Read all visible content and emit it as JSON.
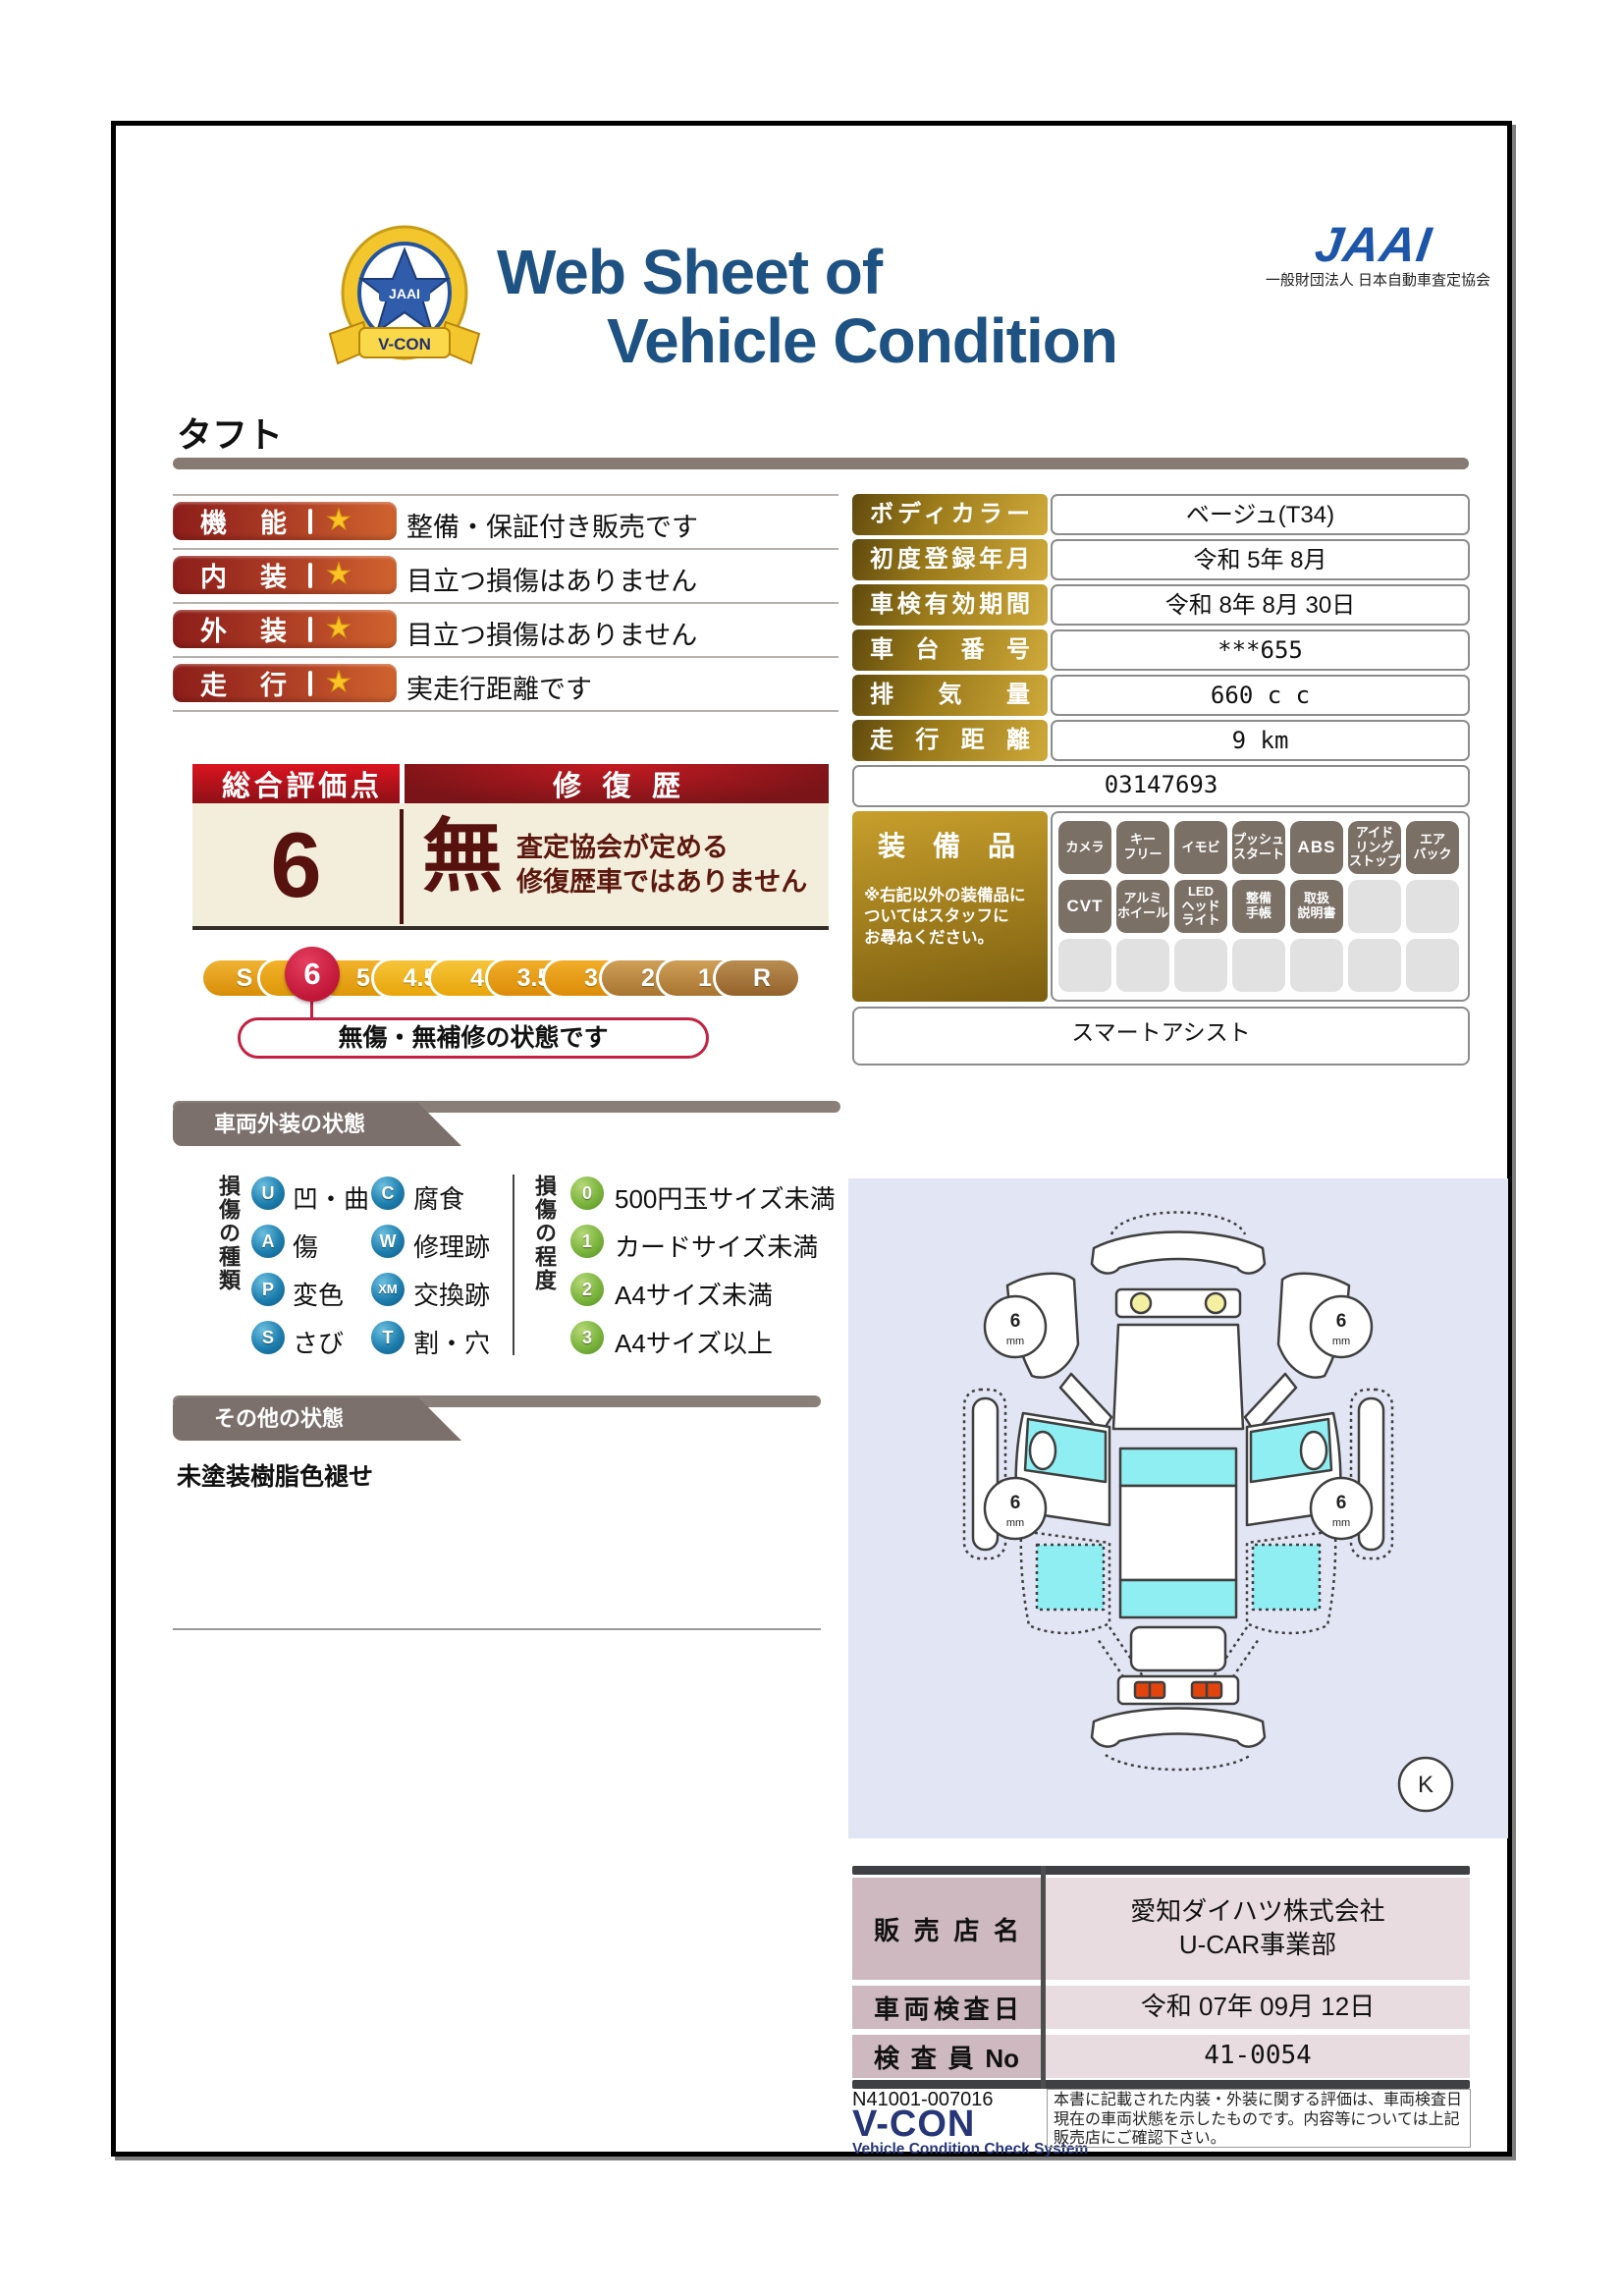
{
  "header": {
    "title_line1": "Web Sheet of",
    "title_line2": "Vehicle Condition",
    "jaai_logo": "JAAI",
    "jaai_subtitle": "一般財団法人 日本自動車査定協会",
    "badge_ribbon": "V-CON",
    "badge_center": "JAAI"
  },
  "vehicle_name": "タフト",
  "ratings": [
    {
      "label": "機能",
      "comment": "整備・保証付き販売です"
    },
    {
      "label": "内装",
      "comment": "目立つ損傷はありません"
    },
    {
      "label": "外装",
      "comment": "目立つ損傷はありません"
    },
    {
      "label": "走行",
      "comment": "実走行距離です"
    }
  ],
  "overall": {
    "header_left": "総合評価点",
    "header_right": "修復歴",
    "score": "6",
    "repair": "無",
    "repair_note_line1": "査定協会が定める",
    "repair_note_line2": "修復歴車ではありません",
    "scale": [
      "S",
      "6",
      "5",
      "4.5",
      "4",
      "3.5",
      "3",
      "2",
      "1",
      "R"
    ],
    "selected": "6",
    "bubble": "無傷・無補修の状態です"
  },
  "info_table": {
    "rows": [
      {
        "label": "ボディカラー",
        "value": "ベージュ(T34)"
      },
      {
        "label": "初度登録年月",
        "value": "令和 5年 8月"
      },
      {
        "label": "車検有効期間",
        "value": "令和 8年 8月 30日"
      },
      {
        "label": "車台番号",
        "value": "***655"
      },
      {
        "label": "排気量",
        "value": "660 c c"
      },
      {
        "label": "走行距離",
        "value": "9 km"
      }
    ],
    "code": "03147693"
  },
  "equipment": {
    "title": "装備品",
    "note": "※右記以外の装備品に\nついてはスタッフに\nお尋ねください。",
    "row1": [
      "カメラ",
      "キー\nフリー",
      "イモビ",
      "プッシュ\nスタート",
      "ABS",
      "アイド\nリング\nストップ",
      "エア\nバック"
    ],
    "row2": [
      "CVT",
      "アルミ\nホイール",
      "LED\nヘッド\nライト",
      "整備\n手帳",
      "取扱\n説明書"
    ],
    "extra": "スマートアシスト"
  },
  "exterior": {
    "section_title": "車両外装の状態",
    "type_label": "損傷の種類",
    "types": [
      {
        "code": "U",
        "label": "凹・曲"
      },
      {
        "code": "C",
        "label": "腐食"
      },
      {
        "code": "A",
        "label": "傷"
      },
      {
        "code": "W",
        "label": "修理跡"
      },
      {
        "code": "P",
        "label": "変色"
      },
      {
        "code": "XM",
        "label": "交換跡"
      },
      {
        "code": "S",
        "label": "さび"
      },
      {
        "code": "T",
        "label": "割・穴"
      }
    ],
    "degree_label": "損傷の程度",
    "degrees": [
      {
        "code": "0",
        "label": "500円玉サイズ未満"
      },
      {
        "code": "1",
        "label": "カードサイズ未満"
      },
      {
        "code": "2",
        "label": "A4サイズ未満"
      },
      {
        "code": "3",
        "label": "A4サイズ以上"
      }
    ],
    "tire_depth": "6",
    "tire_unit": "mm",
    "diagram_mark": "K"
  },
  "other": {
    "section_title": "その他の状態",
    "note": "未塗装樹脂色褪せ"
  },
  "dealer_table": {
    "rows": [
      {
        "label": "販売店名",
        "value": "愛知ダイハツ株式会社\nU-CAR事業部"
      },
      {
        "label": "車両検査日",
        "value": "令和 07年 09月 12日"
      },
      {
        "label": "検査員No",
        "value": "41-0054"
      }
    ]
  },
  "footer": {
    "doc_no": "N41001-007016",
    "vcon": "V-CON",
    "vcon_sub": "Vehicle Condition Check System",
    "note": "本書に記載された内装・外装に関する評価は、車両検査日現在の車両状態を示したものです。内容等については上記販売店にご確認下さい。"
  },
  "colors": {
    "title_navy": "#1e5282",
    "jaai_blue": "#1d55a8",
    "rating_red_left": "#8c1d1a",
    "rating_red_right": "#d0632f",
    "score_maroon": "#571210",
    "cream": "#f3eedb",
    "selected_red": "#c01638",
    "gold": "#9a7a1a",
    "section_gray": "#7b706b",
    "window_cyan": "#8eeef2",
    "diagram_lavender": "#e2e5f3"
  }
}
